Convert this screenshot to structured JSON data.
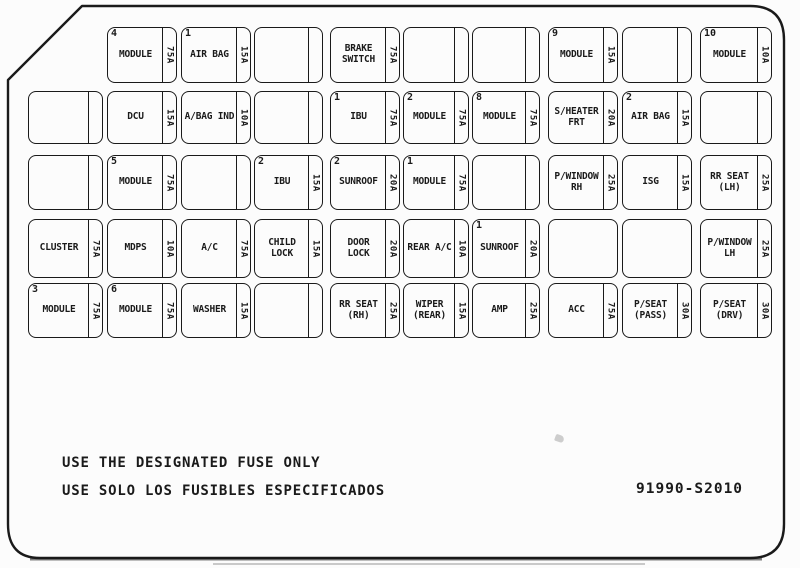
{
  "colors": {
    "ink": "#1a1a1a",
    "background": "#fcfcfc"
  },
  "footer": {
    "line1": "USE THE DESIGNATED FUSE ONLY",
    "line2": "USE SOLO LOS FUSIBLES ESPECIFICADOS",
    "part_number": "91990-S2010"
  },
  "fuse_cells": [
    {
      "row": 1,
      "col": "B",
      "num": "4",
      "label": "MODULE",
      "amp": "75A"
    },
    {
      "row": 1,
      "col": "C",
      "num": "1",
      "label": "AIR BAG",
      "amp": "15A"
    },
    {
      "row": 1,
      "col": "D",
      "blank": true
    },
    {
      "row": 1,
      "col": "E",
      "label": "BRAKE\nSWITCH",
      "amp": "75A"
    },
    {
      "row": 1,
      "col": "F",
      "blank": true
    },
    {
      "row": 1,
      "col": "G",
      "blank": true
    },
    {
      "row": 1,
      "col": "H",
      "num": "9",
      "label": "MODULE",
      "amp": "15A"
    },
    {
      "row": 1,
      "col": "I",
      "blank": true
    },
    {
      "row": 1,
      "col": "J",
      "num": "10",
      "label": "MODULE",
      "amp": "10A"
    },
    {
      "row": 2,
      "col": "A",
      "blank": true
    },
    {
      "row": 2,
      "col": "B",
      "label": "DCU",
      "amp": "15A"
    },
    {
      "row": 2,
      "col": "C",
      "label": "A/BAG IND",
      "amp": "10A"
    },
    {
      "row": 2,
      "col": "D",
      "blank": true
    },
    {
      "row": 2,
      "col": "E",
      "num": "1",
      "label": "IBU",
      "amp": "75A"
    },
    {
      "row": 2,
      "col": "F",
      "num": "2",
      "label": "MODULE",
      "amp": "75A"
    },
    {
      "row": 2,
      "col": "G",
      "num": "8",
      "label": "MODULE",
      "amp": "75A"
    },
    {
      "row": 2,
      "col": "H",
      "label": "S/HEATER\nFRT",
      "amp": "20A"
    },
    {
      "row": 2,
      "col": "I",
      "num": "2",
      "label": "AIR BAG",
      "amp": "15A"
    },
    {
      "row": 2,
      "col": "J",
      "blank": true
    },
    {
      "row": 3,
      "col": "A",
      "blank": true
    },
    {
      "row": 3,
      "col": "B",
      "num": "5",
      "label": "MODULE",
      "amp": "75A"
    },
    {
      "row": 3,
      "col": "C",
      "blank": true
    },
    {
      "row": 3,
      "col": "D",
      "num": "2",
      "label": "IBU",
      "amp": "15A"
    },
    {
      "row": 3,
      "col": "E",
      "num": "2",
      "label": "SUNROOF",
      "amp": "20A"
    },
    {
      "row": 3,
      "col": "F",
      "num": "1",
      "label": "MODULE",
      "amp": "75A"
    },
    {
      "row": 3,
      "col": "G",
      "blank": true
    },
    {
      "row": 3,
      "col": "H",
      "label": "P/WINDOW\nRH",
      "amp": "25A"
    },
    {
      "row": 3,
      "col": "I",
      "label": "ISG",
      "amp": "15A"
    },
    {
      "row": 3,
      "col": "J",
      "label": "RR SEAT\n(LH)",
      "amp": "25A"
    },
    {
      "row": 4,
      "col": "A",
      "label": "CLUSTER",
      "amp": "75A"
    },
    {
      "row": 4,
      "col": "B",
      "label": "MDPS",
      "amp": "10A"
    },
    {
      "row": 4,
      "col": "C",
      "label": "A/C",
      "amp": "75A"
    },
    {
      "row": 4,
      "col": "D",
      "label": "CHILD\nLOCK",
      "amp": "15A"
    },
    {
      "row": 4,
      "col": "E",
      "label": "DOOR\nLOCK",
      "amp": "20A"
    },
    {
      "row": 4,
      "col": "F",
      "label": "REAR A/C",
      "amp": "10A"
    },
    {
      "row": 4,
      "col": "G",
      "num": "1",
      "label": "SUNROOF",
      "amp": "20A"
    },
    {
      "row": 4,
      "col": "H",
      "blank": true,
      "divider": false
    },
    {
      "row": 4,
      "col": "I",
      "blank": true,
      "divider": false
    },
    {
      "row": 4,
      "col": "J",
      "label": "P/WINDOW\nLH",
      "amp": "25A"
    },
    {
      "row": 5,
      "col": "A",
      "num": "3",
      "label": "MODULE",
      "amp": "75A"
    },
    {
      "row": 5,
      "col": "B",
      "num": "6",
      "label": "MODULE",
      "amp": "75A"
    },
    {
      "row": 5,
      "col": "C",
      "label": "WASHER",
      "amp": "15A"
    },
    {
      "row": 5,
      "col": "D",
      "blank": true
    },
    {
      "row": 5,
      "col": "E",
      "label": "RR SEAT\n(RH)",
      "amp": "25A"
    },
    {
      "row": 5,
      "col": "F",
      "label": "WIPER\n(REAR)",
      "amp": "15A"
    },
    {
      "row": 5,
      "col": "G",
      "label": "AMP",
      "amp": "25A"
    },
    {
      "row": 5,
      "col": "H",
      "label": "ACC",
      "amp": "75A"
    },
    {
      "row": 5,
      "col": "I",
      "label": "P/SEAT\n(PASS)",
      "amp": "30A"
    },
    {
      "row": 5,
      "col": "J",
      "label": "P/SEAT\n(DRV)",
      "amp": "30A"
    }
  ]
}
